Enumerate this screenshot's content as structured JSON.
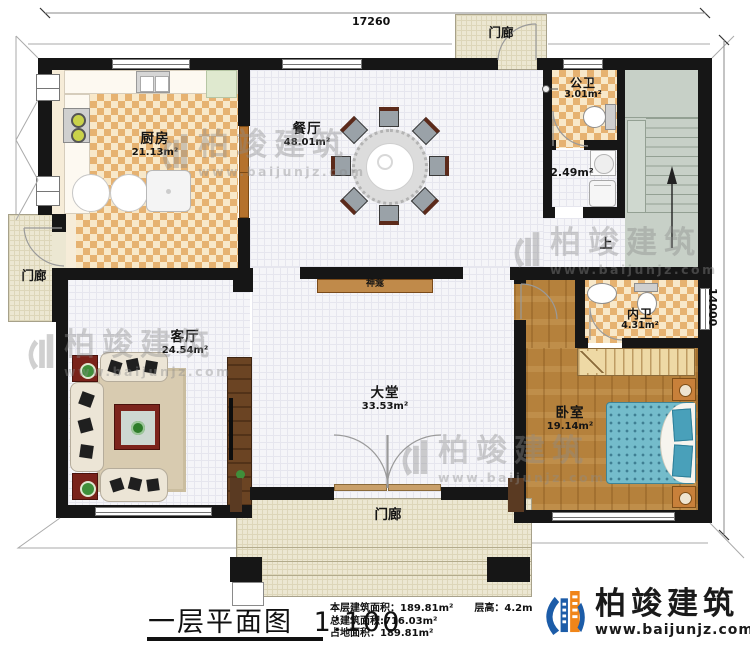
{
  "dimensions": {
    "width_top": "17260",
    "height_right": "14000"
  },
  "rooms": {
    "kitchen": {
      "name": "厨房",
      "area": "21.13m²"
    },
    "dining": {
      "name": "餐厅",
      "area": "48.01m²"
    },
    "public_bath": {
      "name": "公卫",
      "area": "3.01m²"
    },
    "utility": {
      "area": "2.49m²"
    },
    "living": {
      "name": "客厅",
      "area": "24.54m²"
    },
    "hall": {
      "name": "大堂",
      "area": "33.53m²"
    },
    "inner_bath": {
      "name": "内卫",
      "area": "4.31m²"
    },
    "bedroom": {
      "name": "卧室",
      "area": "19.14m²"
    },
    "shrine": {
      "name": "神龛"
    },
    "stairs": {
      "up": "上"
    },
    "porch_top": {
      "name": "门廊"
    },
    "porch_left": {
      "name": "门廊"
    },
    "porch_bottom": {
      "name": "门廊"
    }
  },
  "title_block": {
    "title": "一层平面图",
    "scale": "1:100",
    "floor_area_label": "本层建筑面积：",
    "floor_area_value": "189.81m²",
    "height_label": "层高：",
    "height_value": "4.2m",
    "total_area_label": "总建筑面积:",
    "total_area_value": "716.03m²",
    "footprint_label": "占地面积：",
    "footprint_value": "189.81m²"
  },
  "branding": {
    "company": "柏竣建筑",
    "website": "www.baijunjz.com"
  }
}
